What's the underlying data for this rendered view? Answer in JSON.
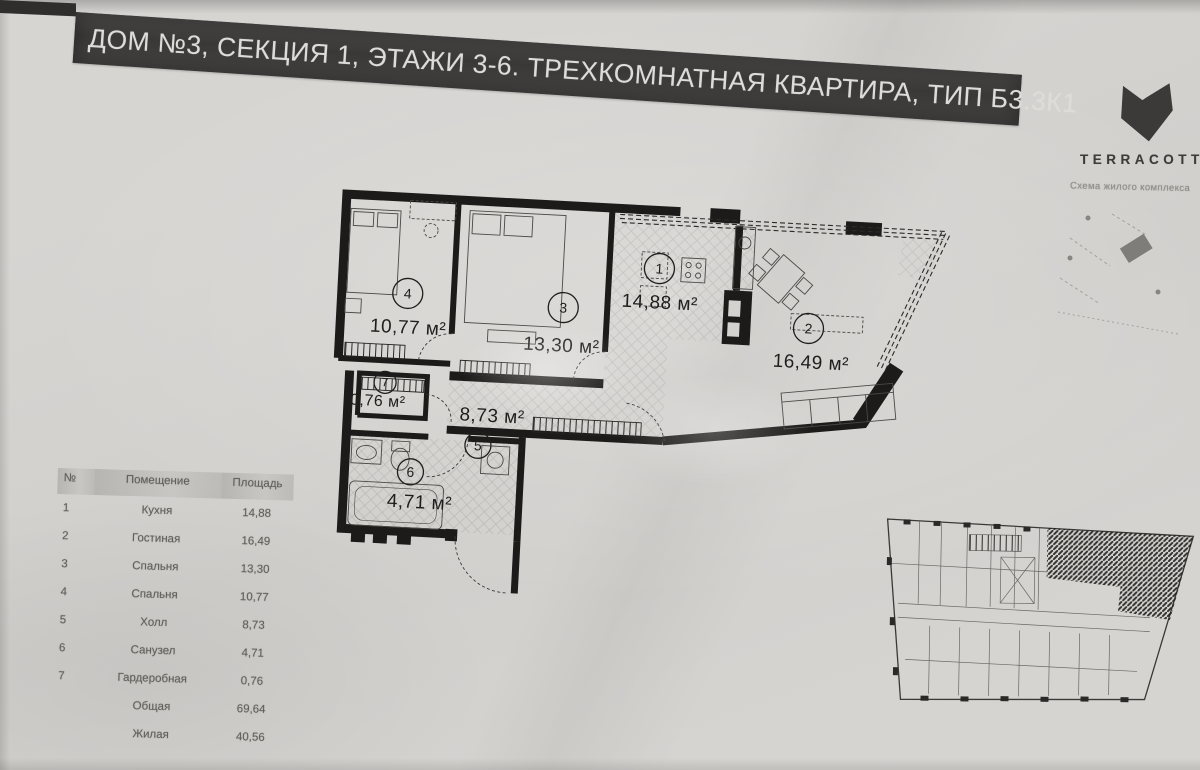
{
  "page": {
    "title_banner": "ДОМ №3, СЕКЦИЯ 1, ЭТАЖИ 3-6. ТРЕХКОМНАТНАЯ КВАРТИРА, ТИП Б3.3К1"
  },
  "brand": {
    "name": "TERRACOTTA",
    "tagline": "Схема жилого комплекса"
  },
  "floor_plan": {
    "rooms": [
      {
        "num": "1",
        "area": "14,88 м²"
      },
      {
        "num": "2",
        "area": "16,49 м²"
      },
      {
        "num": "3",
        "area": "13,30 м²"
      },
      {
        "num": "4",
        "area": "10,77 м²"
      },
      {
        "num": "5",
        "area": "8,73 м²"
      },
      {
        "num": "6",
        "area": "4,71 м²"
      },
      {
        "num": "7",
        "area": "0,76 м²"
      }
    ]
  },
  "legend_table": {
    "headers": [
      "№",
      "Помещение",
      "Площадь"
    ],
    "rows": [
      {
        "num": "1",
        "name": "Кухня",
        "area": "14,88"
      },
      {
        "num": "2",
        "name": "Гостиная",
        "area": "16,49"
      },
      {
        "num": "3",
        "name": "Спальня",
        "area": "13,30"
      },
      {
        "num": "4",
        "name": "Спальня",
        "area": "10,77"
      },
      {
        "num": "5",
        "name": "Холл",
        "area": "8,73"
      },
      {
        "num": "6",
        "name": "Санузел",
        "area": "4,71"
      },
      {
        "num": "7",
        "name": "Гардеробная",
        "area": "0,76"
      },
      {
        "num": "",
        "name": "Общая",
        "area": "69,64"
      },
      {
        "num": "",
        "name": "Жилая",
        "area": "40,56"
      }
    ]
  },
  "colors": {
    "paper": "#d4d2cf",
    "ink": "#1c1b1a",
    "banner_bg": "#3f3e3d",
    "banner_text": "#dedcd8",
    "faded_ink": "#615f5b"
  }
}
